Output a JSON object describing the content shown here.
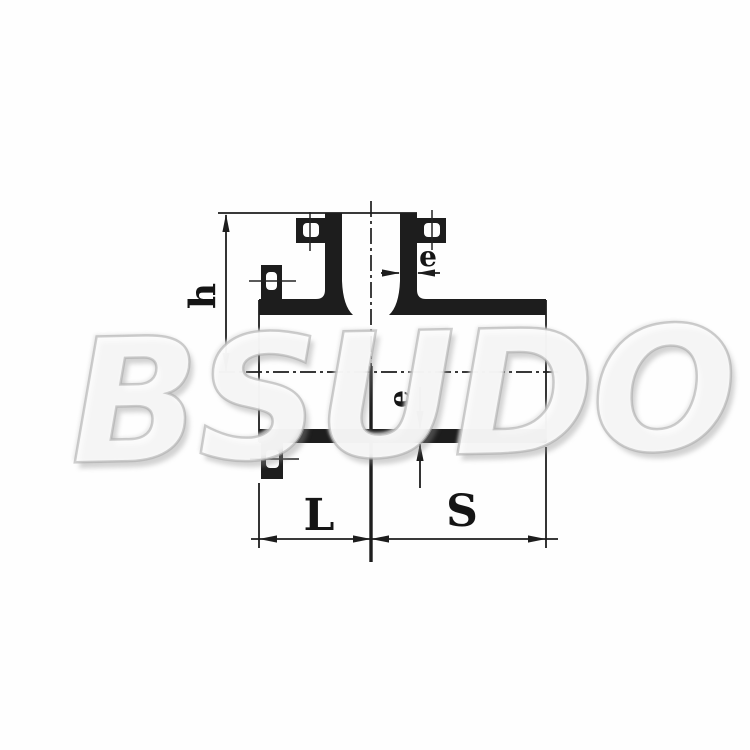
{
  "figure": {
    "type": "technical-drawing",
    "subject": "molded tee pipe fitting cross-section with dimension lines",
    "labels": {
      "branch_height": "h",
      "branch_wall_thickness": "e",
      "run_wall_thickness": "e",
      "left_length": "L",
      "right_length": "S"
    },
    "watermark": "BSUDO",
    "colors": {
      "ink": "#1d1d1d",
      "background": "#ffffff",
      "watermark": "#cccccc"
    }
  }
}
